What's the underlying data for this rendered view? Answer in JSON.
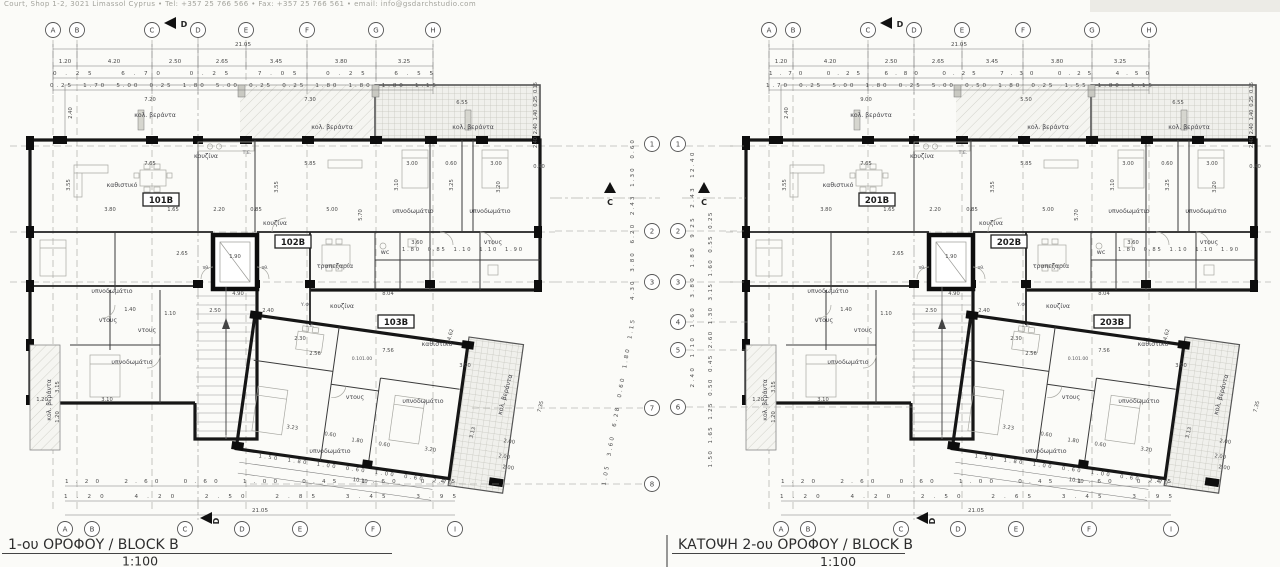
{
  "page": {
    "bg": "#fbfbf8"
  },
  "header": {
    "contact_line": "Court, Shop 1-2, 3021 Limassol Cyprus  •  Tel: +357 25 766 566  •  Fax: +357 25 766 561  •  email: info@gsdarchstudio.com"
  },
  "labels": {
    "living": "καθιστικό",
    "kitchen": "κουζίνα",
    "dining": "τραπεζαρία",
    "bedroom": "υπνοδωμάτιο",
    "shower": "ντους",
    "wc": "wc",
    "veranda": "κολ. βεράντα",
    "te": "Τ.Ε.",
    "landing": "πθ.",
    "yf": "Υ.Φ",
    "level": "0.101.00"
  },
  "plans": [
    {
      "title": "1-ου ΟΡΟΦΟΥ / BLOCK B",
      "scale": "1:100",
      "units": [
        "101B",
        "102B",
        "103B"
      ],
      "section_marker": "C",
      "top_marker": "D",
      "bottom_marker": "D",
      "grid_top": {
        "letters": [
          "A",
          "B",
          "C",
          "D",
          "E",
          "F",
          "G",
          "H"
        ],
        "total": "21.05",
        "row1": [
          "1.20",
          "4.20",
          "2.50",
          "2.65",
          "3.45",
          "3.80",
          "3.25"
        ],
        "row2": [
          "0.25",
          "6.70",
          "0.25",
          "7.05",
          "0.25",
          "6.55"
        ],
        "row3": [
          "0.25",
          "1.70",
          "5.00",
          "0.25",
          "1.80",
          "5.00",
          "0.25",
          "0.25",
          "1.80",
          "1.80",
          "1.80",
          "1.15"
        ]
      },
      "grid_bottom": {
        "letters": [
          "A",
          "B",
          "C",
          "D",
          "E",
          "F",
          "I"
        ],
        "total": "21.05",
        "row1": [
          "1.20",
          "2.60",
          "0.60",
          "1.00",
          "0.45",
          "1.60",
          "0.45"
        ],
        "row2": [
          "1.20",
          "4.20",
          "2.50",
          "2.85",
          "3.45",
          "3.95"
        ]
      },
      "grid_side": {
        "numbers": [
          "1",
          "2",
          "3",
          "7",
          "8"
        ],
        "col1": [
          "4.30",
          "3.80",
          "6.20",
          "2.43",
          "1.30",
          "0.60"
        ],
        "col2": [
          "1.05",
          "3.60",
          "6.28",
          "0.60",
          "1.80",
          "1.15"
        ]
      },
      "veranda_dims": [
        "7.20",
        "7.30",
        "6.55"
      ],
      "veranda_side_dims": [
        "2.40",
        "2.40",
        "1.40",
        "0.25",
        "0.15"
      ],
      "wing_dims": {
        "segments": [
          "1.50",
          "1.80",
          "1.00",
          "0.60",
          "1.00",
          "0.60",
          "2.70"
        ],
        "total": "10.10",
        "end": [
          "2.00",
          "2.00"
        ]
      },
      "wc_row": [
        "1.80",
        "0.85",
        "1.10",
        "1.10",
        "1.90"
      ],
      "dims": {
        "d1": "7.65",
        "d2": "5.85",
        "d3": "3.00",
        "d4": "0.60",
        "d5": "3.00",
        "d6": "0.40",
        "v1": "3.55",
        "v2": "3.55",
        "v3": "3.25",
        "v4": "3.10",
        "v5": "3.20",
        "v6": "5.70",
        "r1": "3.80",
        "r2": "1.65",
        "r3": "2.20",
        "r4": "0.85",
        "r5": "5.00",
        "c1": "2.65",
        "c2": "1.90",
        "c3": "4.90",
        "c4": "8.04",
        "c5": "2.50",
        "c6": "2.40",
        "c7": "3.60",
        "w1": "7.56",
        "w2": "2.56",
        "w3": "3.90",
        "w4": "4.62",
        "w5": "7.35",
        "w6": "2.30",
        "b1": "3.23",
        "b2": "0.60",
        "b3": "1.80",
        "b4": "0.60",
        "b5": "3.20",
        "b6": "3.13",
        "b7": "2.00",
        "l1": "3.10",
        "l2": "1.20",
        "l6": "1.40",
        "l7": "1.10",
        "lv1": "3.15",
        "lv2": "1.20"
      }
    },
    {
      "title": "ΚΑΤΟΨΗ 2-ου ΟΡΟΦΟΥ / BLOCK B",
      "scale": "1:100",
      "units": [
        "201B",
        "202B",
        "203B"
      ],
      "section_marker": "C",
      "top_marker": "D",
      "bottom_marker": "D",
      "grid_top": {
        "letters": [
          "A",
          "B",
          "C",
          "D",
          "E",
          "F",
          "G",
          "H"
        ],
        "total": "21.05",
        "row1": [
          "1.20",
          "4.20",
          "2.50",
          "2.65",
          "3.45",
          "3.80",
          "3.25"
        ],
        "row2": [
          "1.70",
          "0.25",
          "6.80",
          "0.25",
          "7.30",
          "0.25",
          "4.50"
        ],
        "row3": [
          "1.70",
          "0.25",
          "5.00",
          "1.80",
          "0.25",
          "5.00",
          "0.50",
          "1.80",
          "0.25",
          "1.55",
          "1.80",
          "1.15"
        ]
      },
      "grid_bottom": {
        "letters": [
          "A",
          "B",
          "C",
          "D",
          "E",
          "F",
          "I"
        ],
        "total": "21.05",
        "row1": [
          "1.20",
          "2.60",
          "0.60",
          "1.00",
          "0.45",
          "1.60",
          "0.45"
        ],
        "row2": [
          "1.20",
          "4.20",
          "2.50",
          "2.65",
          "3.45",
          "3.95"
        ]
      },
      "grid_side": {
        "numbers": [
          "1",
          "2",
          "3",
          "4",
          "5",
          "6"
        ],
        "col1": [
          "2.40",
          "1.10",
          "1.60",
          "3.80",
          "1.80",
          "9.25",
          "2.43",
          "12.40"
        ],
        "col2": [
          "1.50",
          "1.65",
          "1.25",
          "0.50",
          "0.45",
          "2.60",
          "1.30",
          "3.15",
          "1.60",
          "0.55",
          "0.25"
        ]
      },
      "veranda_dims": [
        "9.00",
        "5.50",
        "6.55"
      ],
      "veranda_side_dims": [
        "2.40",
        "2.40",
        "1.40",
        "0.25",
        "0.15"
      ],
      "wing_dims": {
        "segments": [
          "1.50",
          "1.80",
          "1.00",
          "0.60",
          "1.00",
          "0.60",
          "2.70"
        ],
        "total": "10.10",
        "end": [
          "2.00",
          "2.00"
        ]
      },
      "wc_row": [
        "1.80",
        "0.85",
        "1.10",
        "1.10",
        "1.90"
      ],
      "dims": {
        "d1": "7.65",
        "d2": "5.85",
        "d3": "3.00",
        "d4": "0.60",
        "d5": "3.00",
        "d6": "0.40",
        "v1": "3.55",
        "v2": "3.55",
        "v3": "3.25",
        "v4": "3.10",
        "v5": "3.20",
        "v6": "5.70",
        "r1": "3.80",
        "r2": "1.65",
        "r3": "2.20",
        "r4": "0.85",
        "r5": "5.00",
        "c1": "2.65",
        "c2": "1.90",
        "c3": "4.90",
        "c4": "8.04",
        "c5": "2.50",
        "c6": "2.40",
        "c7": "3.60",
        "w1": "7.56",
        "w2": "2.56",
        "w3": "3.90",
        "w4": "4.62",
        "w5": "7.35",
        "w6": "2.30",
        "b1": "3.23",
        "b2": "0.60",
        "b3": "1.80",
        "b4": "0.60",
        "b5": "3.20",
        "b6": "3.13",
        "b7": "2.00",
        "l1": "3.10",
        "l2": "1.20",
        "l6": "1.40",
        "l7": "1.10",
        "lv1": "3.15",
        "lv2": "1.20"
      }
    }
  ]
}
